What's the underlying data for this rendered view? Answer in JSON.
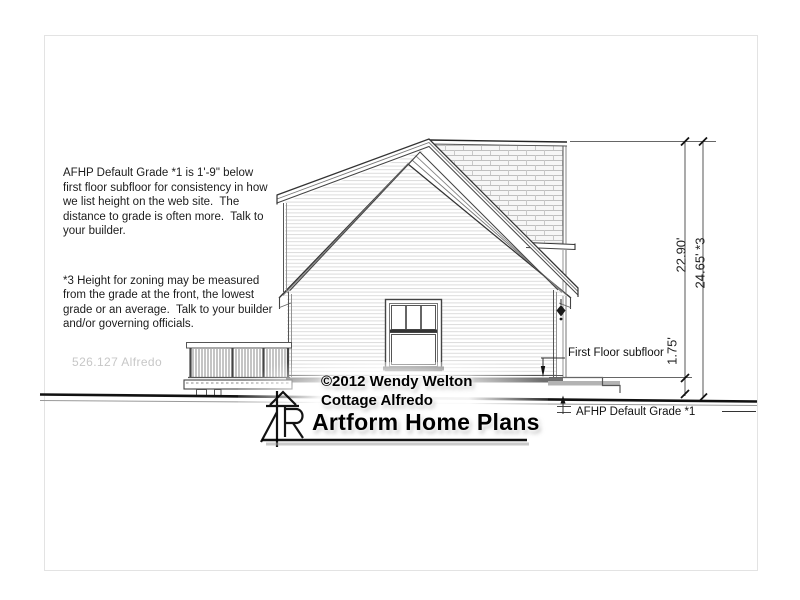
{
  "notes": {
    "paragraph1": "AFHP Default Grade *1 is 1'-9\" below\nfirst floor subfloor for consistency in how\nwe list height on the web site.  The\ndistance to grade is often more.  Talk to\nyour builder.",
    "paragraph2": "*3 Height for zoning may be measured\nfrom the grade at the front, the lowest\ngrade or an average.  Talk to your builder\nand/or governing officials."
  },
  "plan_watermark": "526.127 Alfredo",
  "dimensions": {
    "subfloor_to_peak": "22.90'",
    "grade_to_peak": "24.65' *3",
    "grade_to_subfloor": "1.75'"
  },
  "labels": {
    "first_floor_subfloor": "First Floor subfloor",
    "default_grade": "AFHP Default Grade *1"
  },
  "branding": {
    "copyright": "©2012 Wendy Welton",
    "plan_name": "Cottage Alfredo",
    "company": "Artform Home Plans"
  },
  "colors": {
    "line_dark": "#222222",
    "line_mid": "#555555",
    "siding": "#d9d9d9",
    "shingle": "#bfbfbf",
    "watermark_grey": "#c7c7c7"
  }
}
